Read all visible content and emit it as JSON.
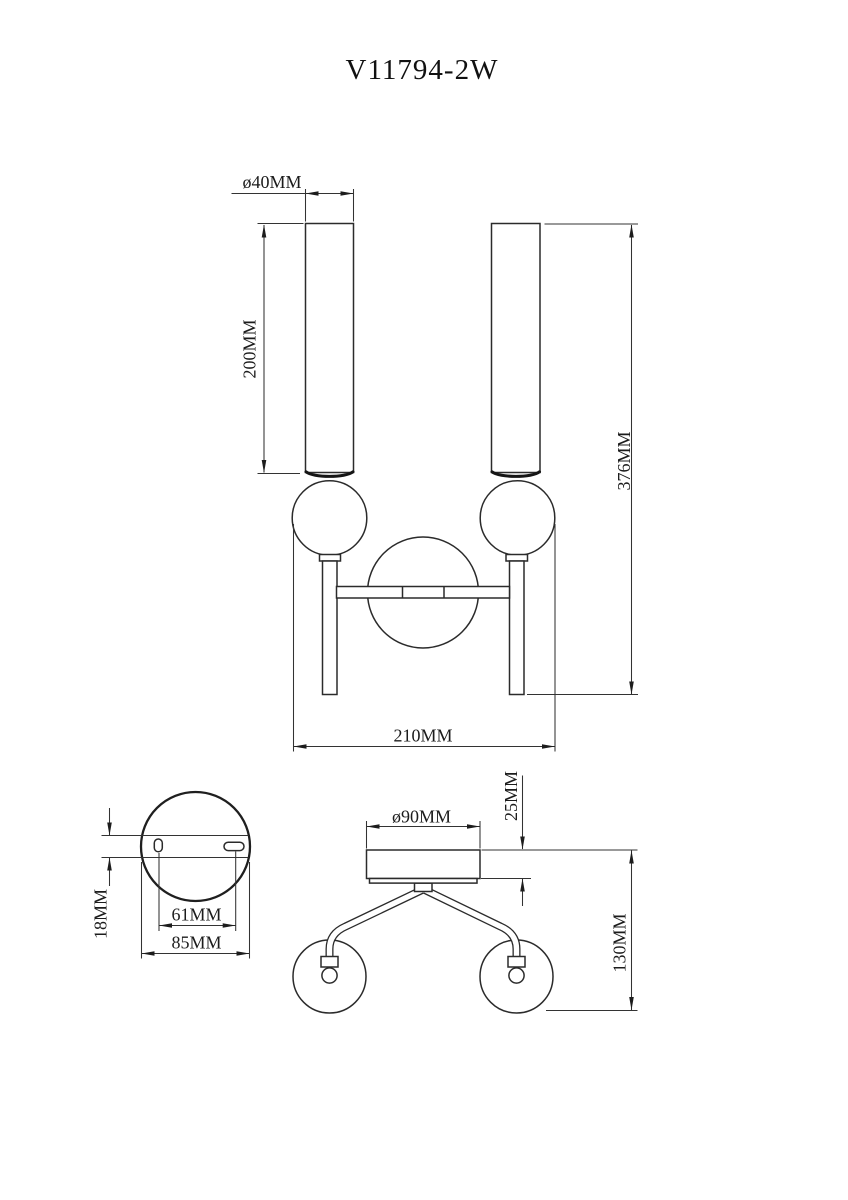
{
  "title": "V11794-2W",
  "front_view": {
    "shade_diameter": "ø40MM",
    "shade_length": "200MM",
    "overall_height": "376MM",
    "overall_width": "210MM"
  },
  "backplate_view": {
    "bracket_height": "18MM",
    "hole_spacing": "61MM",
    "plate_diameter": "85MM"
  },
  "top_view": {
    "canopy_diameter": "ø90MM",
    "canopy_depth": "25MM",
    "projection": "130MM"
  }
}
